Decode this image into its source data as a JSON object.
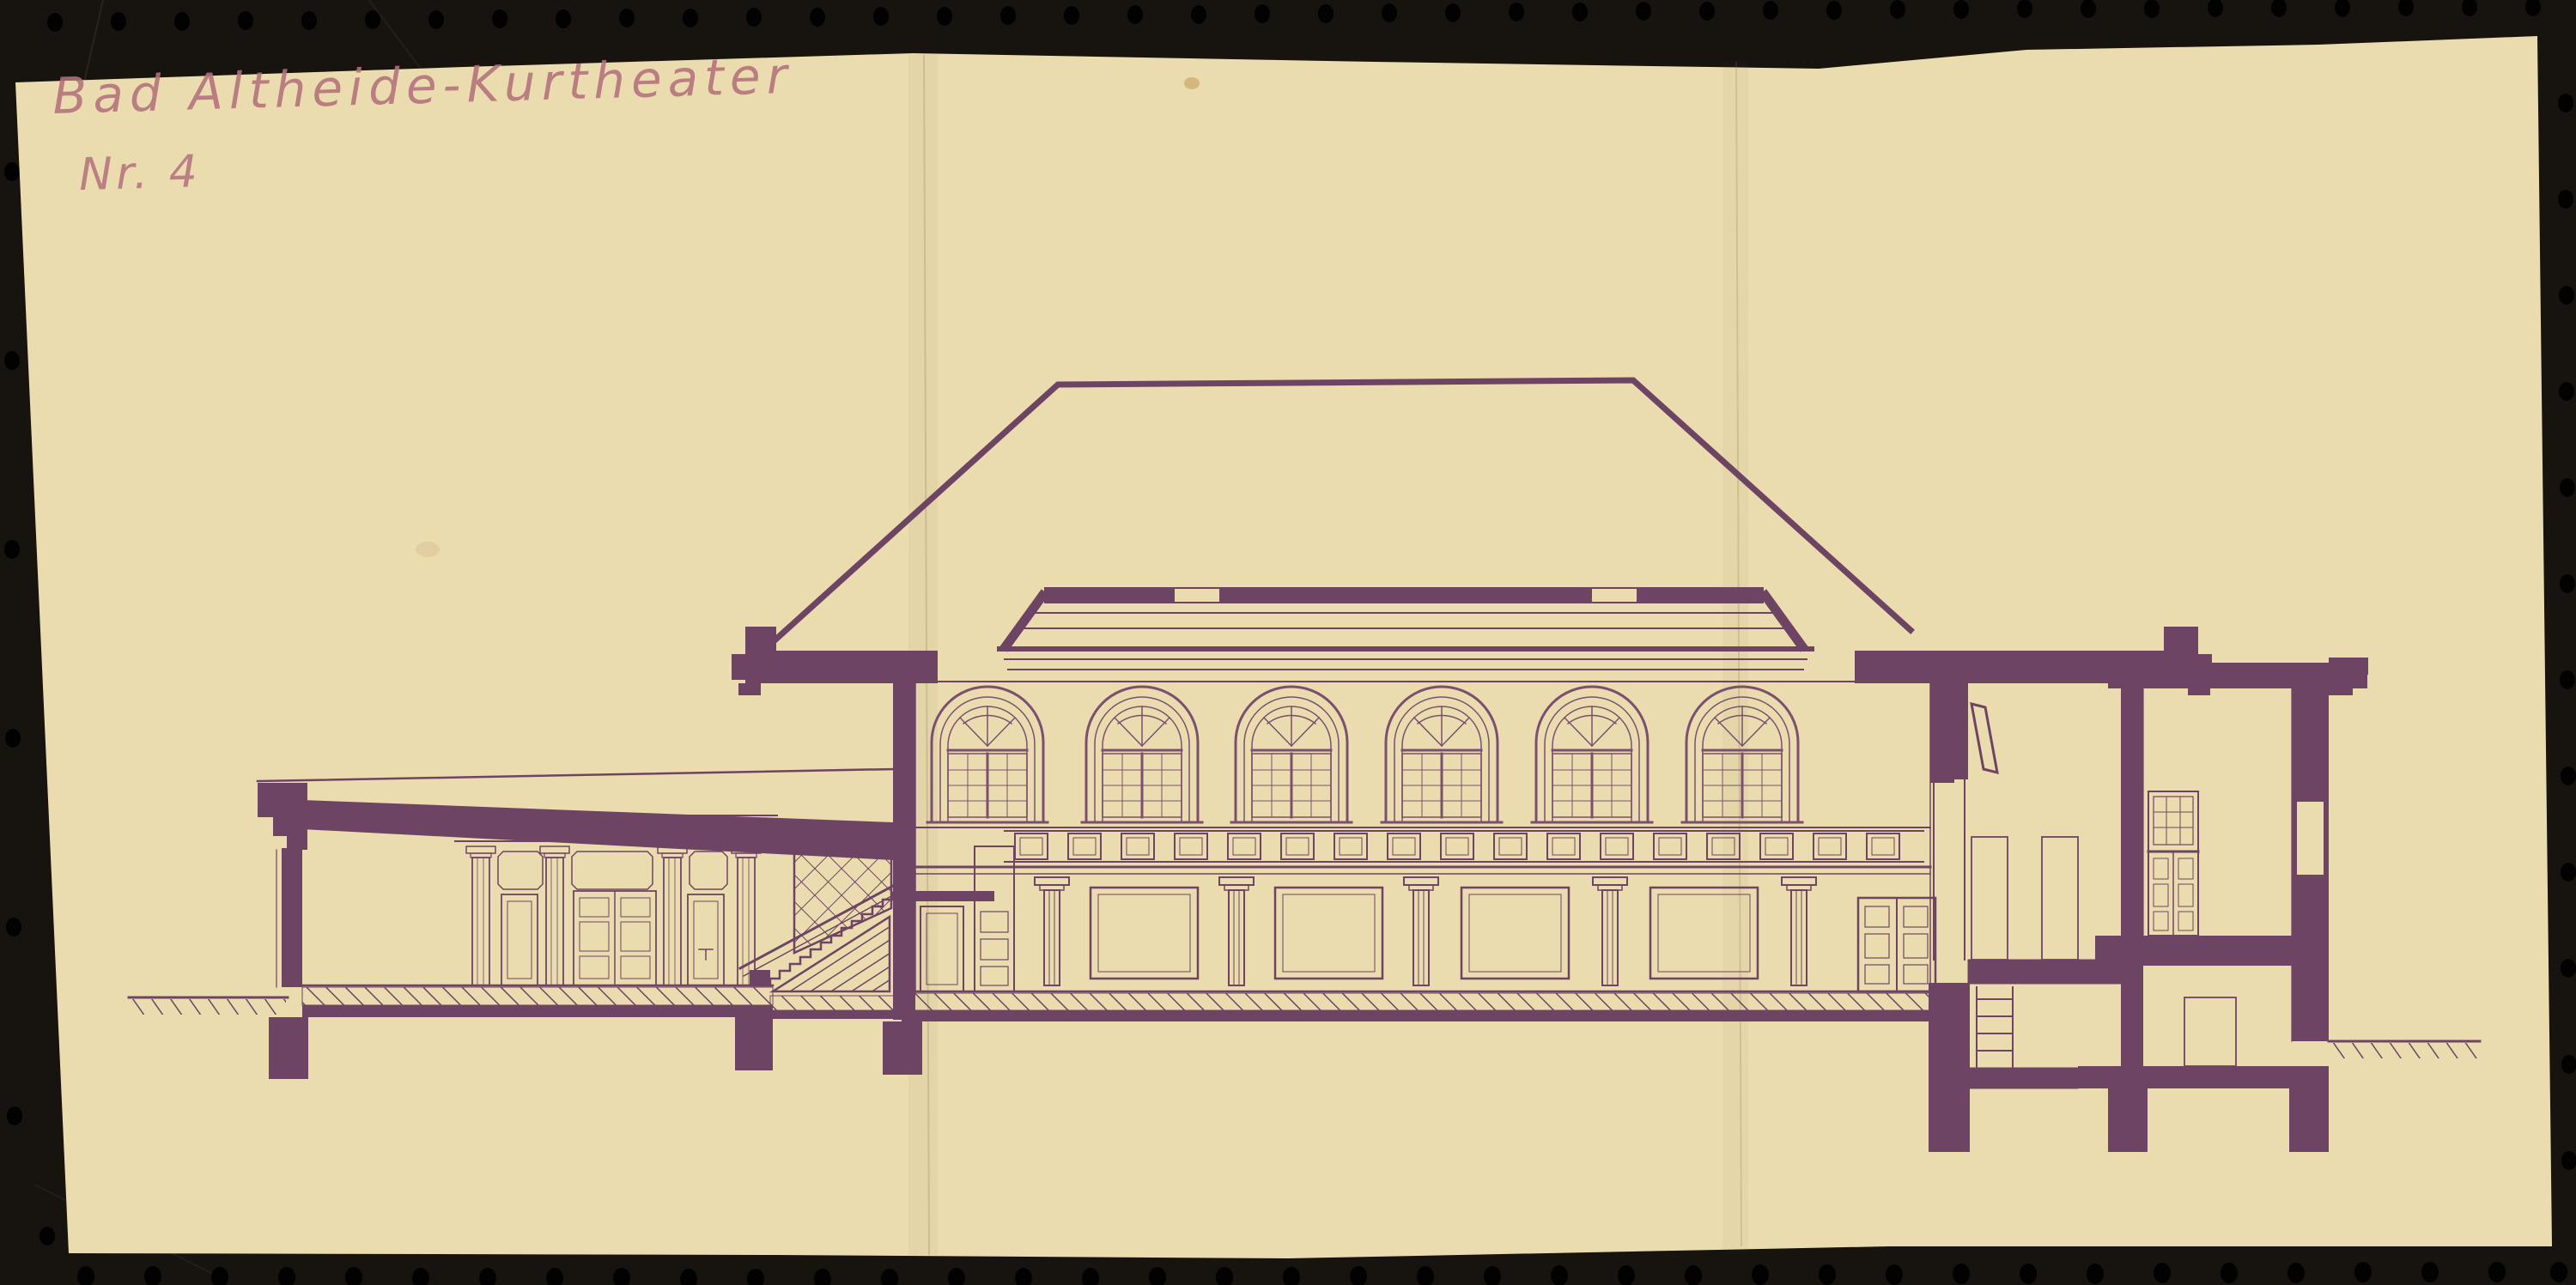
{
  "annotation": {
    "title": "Bad Altheide-Kurtheater",
    "number": "Nr. 4"
  },
  "scan": {
    "board_color": "#17130f",
    "paper_color": "#eadcae",
    "ink_color": "#6e4464",
    "ink_fine_color": "#82537506",
    "pencil_color": "#b4717d",
    "drawing_type": "building-cross-section"
  }
}
